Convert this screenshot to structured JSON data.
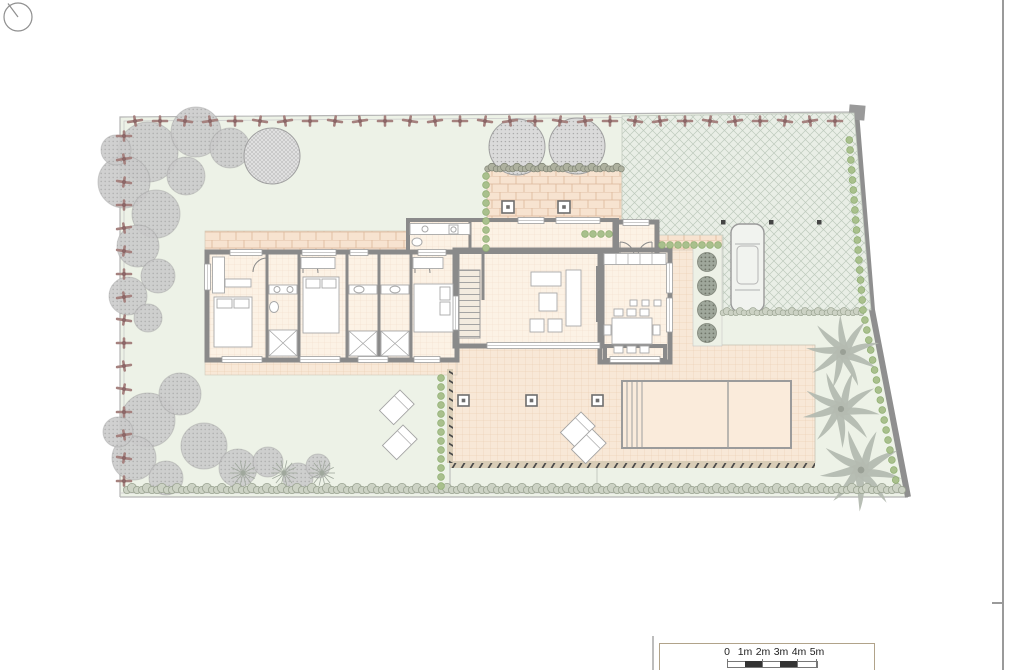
{
  "plan": {
    "kind": "villa-ground-floor-site-plan",
    "visible_text": [
      "0",
      "1m",
      "2m",
      "3m",
      "4m",
      "5m"
    ]
  },
  "scale_bar": {
    "labels": [
      "0",
      "1m",
      "2m",
      "3m",
      "4m",
      "5m"
    ]
  },
  "north_indicator": {
    "icon": "north-indicator-icon"
  },
  "colors": {
    "page_bg": "#ffffff",
    "lawn": "#edf2e7",
    "terrace": "#f8e8d7",
    "terrace_grid": "#ecd2b8",
    "brick": "#f7e3d0",
    "brick_line": "#dcb79a",
    "floor": "#fcf2e5",
    "floor_grid": "#f0ddc7",
    "wall": "#8a8a8a",
    "boundary": "#b5b5b5",
    "drive_bg": "#e9eee6",
    "drive_line": "#becabd",
    "pool": "#faebdb",
    "pool_edge": "#9b9b9b",
    "hedge_red": "#a5817e",
    "hedge_red_dark": "#8c6767",
    "hedge_green": "#9aa391",
    "hedge_green_fill": "#ccd2c4",
    "plant_green": "#a9c08d",
    "tree_gray": "#cbcbcb",
    "tree_edge": "#a0a0a0",
    "palm": "#b4bab1",
    "shrub_dark": "#9fa79b",
    "band_bg": "#d9cdb7",
    "band_mark": "#4a4a4a",
    "furniture_edge": "#a8a8a8",
    "page_line": "#9a9a9a",
    "scale_box_edge": "#b1a38a",
    "text": "#222222"
  }
}
